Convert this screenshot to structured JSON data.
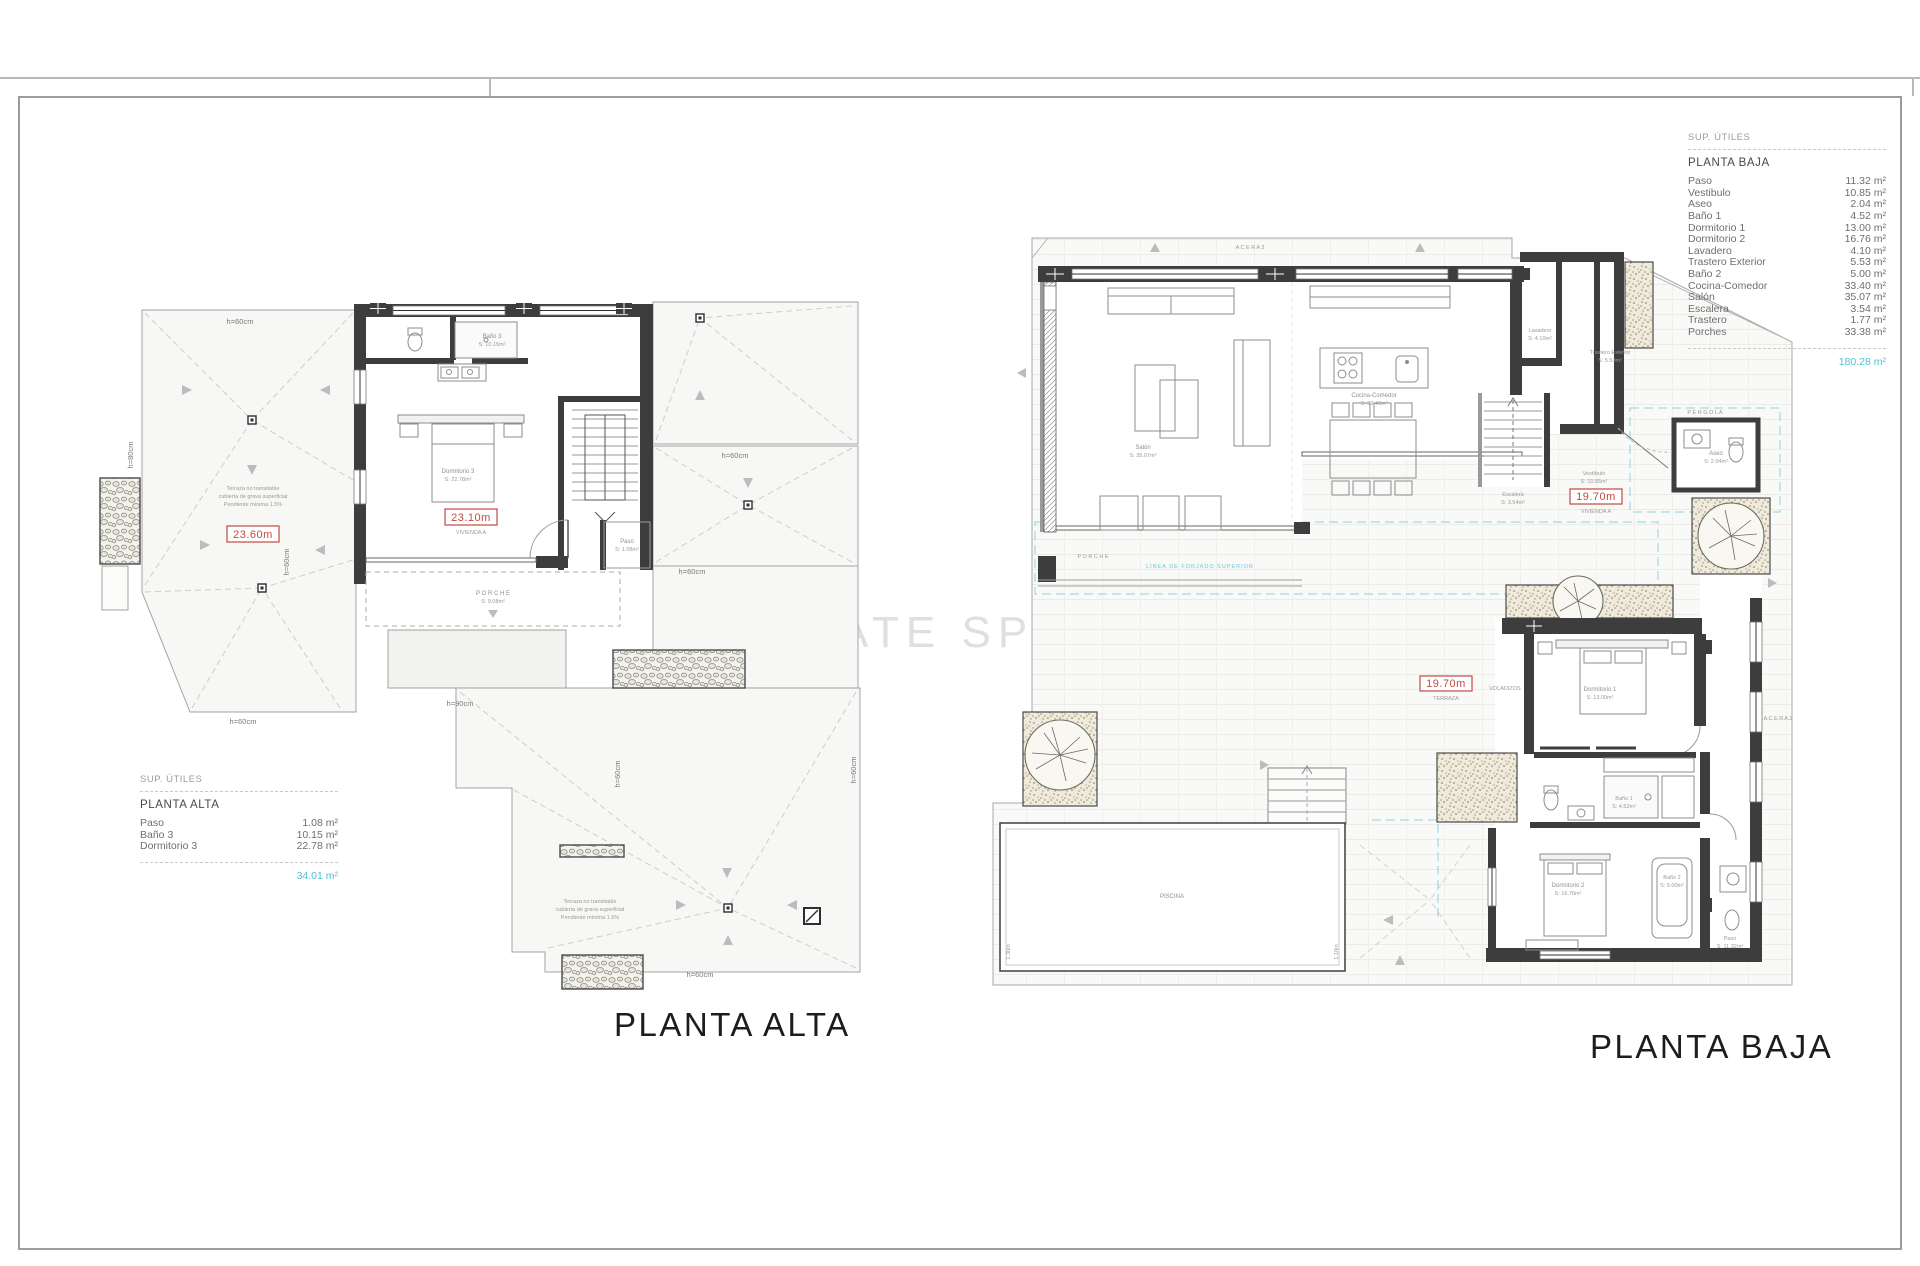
{
  "page": {
    "watermark": "- ESTATE SPAIN",
    "title_alta": "PLANTA ALTA",
    "title_baja": "PLANTA BAJA"
  },
  "tables": {
    "alta": {
      "header": "SUP. ÚTILES",
      "floor": "PLANTA ALTA",
      "rows": [
        {
          "label": "Paso",
          "value": "1.08 m²"
        },
        {
          "label": "Baño 3",
          "value": "10.15 m²"
        },
        {
          "label": "Dormitorio 3",
          "value": "22.78 m²"
        }
      ],
      "total": "34.01 m²"
    },
    "baja": {
      "header": "SUP. ÚTILES",
      "floor": "PLANTA BAJA",
      "rows": [
        {
          "label": "Paso",
          "value": "11.32 m²"
        },
        {
          "label": "Vestibulo",
          "value": "10.85 m²"
        },
        {
          "label": "Aseo",
          "value": "2.04 m²"
        },
        {
          "label": "Baño 1",
          "value": "4.52 m²"
        },
        {
          "label": "Dormitorio 1",
          "value": "13.00 m²"
        },
        {
          "label": "Dormitorio 2",
          "value": "16.76 m²"
        },
        {
          "label": "Lavadero",
          "value": "4.10 m²"
        },
        {
          "label": "Trastero Exterior",
          "value": "5.53 m²"
        },
        {
          "label": "Baño 2",
          "value": "5.00 m²"
        },
        {
          "label": "Cocina-Comedor",
          "value": "33.40 m²"
        },
        {
          "label": "Salón",
          "value": "35.07 m²"
        },
        {
          "label": "Escalera",
          "value": "3.54 m²"
        },
        {
          "label": "Trastero",
          "value": "1.77 m²"
        },
        {
          "label": "Porches",
          "value": "33.38 m²"
        }
      ],
      "total": "180.28 m²"
    }
  },
  "plan_alta": {
    "d60": "h=60cm",
    "d80": "h=80cm",
    "d90": "h=90cm",
    "m_terrace": "23.60m",
    "m_dwelling": "23.10m",
    "dwelling_sub": "VIVIENDA A",
    "note1": "Terraza no transitable",
    "note2": "cubierta de grava superficial",
    "note3": "Pendiente mínima 1.5%",
    "bano3": "Baño 3",
    "bano3_a": "S: 10.15m²",
    "dorm3": "Dormitorio 3",
    "dorm3_a": "S: 22.78m²",
    "paso": "Paso",
    "paso_a": "S: 1.08m²",
    "porche": "P O R C H E",
    "porche_a": "S: 9.08m²"
  },
  "plan_baja": {
    "acera3": "A C E R A  3",
    "acera2": "A C E R A  2",
    "salon": "Salón",
    "salon_a": "S: 35.07m²",
    "cocina": "Cocina-Comedor",
    "cocina_a": "S: 33.40m²",
    "lavadero": "Lavadero",
    "lavadero_a": "S: 4.10m²",
    "trastero_ext": "Trastero Exterior",
    "trastero_ext_a": "S: 5.53m²",
    "escalera": "Escalera",
    "escalera_a": "S: 3.54m²",
    "vestibulo": "Vestíbulo",
    "vestibulo_a": "S: 10.85m²",
    "m1": "19.70m",
    "m1_sub": "VIVIENDA A",
    "m2": "19.70m",
    "m2_sub": "TERRAZA",
    "voladizos": "VOLADIZOS",
    "pergola": "P É R G O L A",
    "aseo": "Aseo",
    "aseo_a": "S: 2.04m²",
    "linea": "LÍNEA DE FORJADO SUPERIOR",
    "porche": "P O R C H E",
    "dorm1": "Dormitorio 1",
    "dorm1_a": "S: 13.00m²",
    "bano1": "Baño 1",
    "bano1_a": "S: 4.52m²",
    "dorm2": "Dormitorio 2",
    "dorm2_a": "S: 16.76m²",
    "bano2": "Baño 2",
    "bano2_a": "S: 5.00m²",
    "paso": "Paso",
    "paso_a": "S: 11.32m²",
    "piscina": "PISCINA",
    "pool_d1": "1.30m",
    "pool_d2": "1.10m"
  }
}
